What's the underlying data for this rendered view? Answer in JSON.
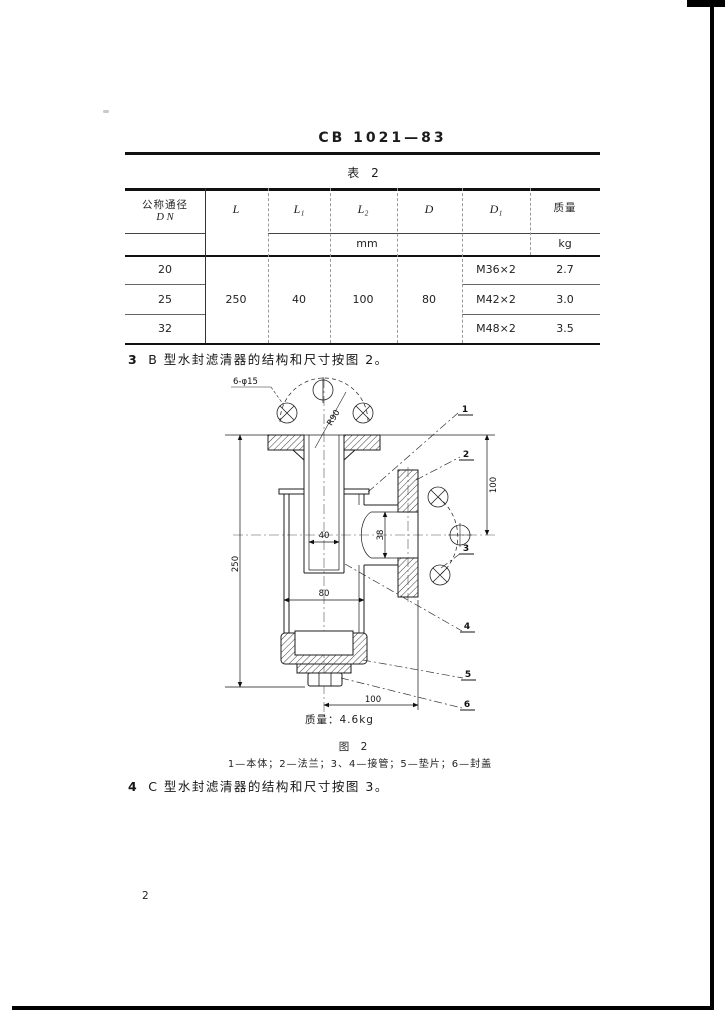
{
  "page": {
    "code": "CB 1021—83",
    "number": "2"
  },
  "table": {
    "title": "表 2",
    "headers": {
      "dn1": "公称通径",
      "dn2": "D N",
      "l": "L",
      "l1": "L₁",
      "l2": "L₂",
      "d": "D",
      "d1": "D₁",
      "mass": "质量"
    },
    "units": {
      "mm": "mm",
      "kg": "kg"
    },
    "merged": {
      "l": "250",
      "l1": "40",
      "l2": "100",
      "d": "80"
    },
    "rows": [
      {
        "dn": "20",
        "thread": "M36×2",
        "mass": "2.7"
      },
      {
        "dn": "25",
        "thread": "M42×2",
        "mass": "3.0"
      },
      {
        "dn": "32",
        "thread": "M48×2",
        "mass": "3.5"
      }
    ]
  },
  "sections": {
    "s3_num": "3",
    "s3_text": "B 型水封滤清器的结构和尺寸按图 2。",
    "s4_num": "4",
    "s4_text": "C 型水封滤清器的结构和尺寸按图 3。"
  },
  "figure": {
    "dims": {
      "holes": "6-φ15",
      "radius": "R90",
      "tube": "40",
      "body": "80",
      "port": "38",
      "height": "250",
      "side": "100",
      "offset": "100"
    },
    "mass": "质量：4.6kg",
    "caption": "图 2",
    "legend": "1—本体；2—法兰；3、4—接管；5—垫片；6—封盖",
    "callouts": [
      "1",
      "2",
      "3",
      "4",
      "5",
      "6"
    ]
  }
}
